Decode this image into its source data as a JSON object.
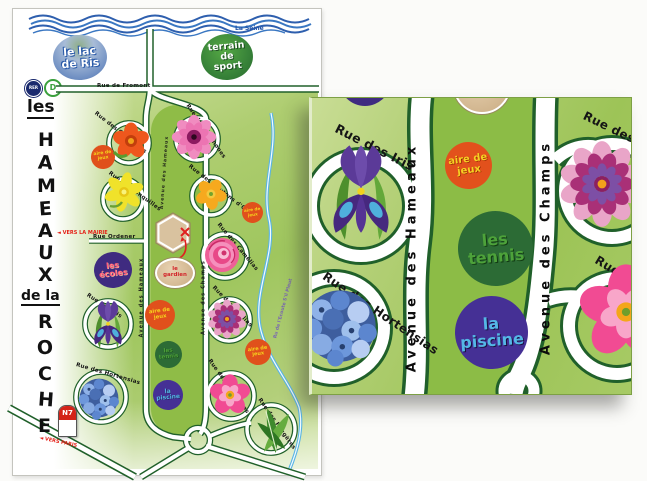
{
  "page": {
    "river_label": "La Seine",
    "lake": {
      "l1": "le lac",
      "l2": "de Ris"
    },
    "sport": {
      "l1": "terrain",
      "l2": "de",
      "l3": "sport"
    },
    "rer": {
      "badge": "RER",
      "line": "D",
      "arrow": "◄"
    },
    "title": {
      "les": "les",
      "hameaux": [
        "H",
        "A",
        "M",
        "E",
        "A",
        "U",
        "X"
      ],
      "dela": "de la",
      "roche": [
        "R",
        "O",
        "C",
        "H",
        "E"
      ]
    },
    "streets": {
      "fromont": "Rue de Fromont",
      "ordener": "Rue Ordener",
      "capucines": "Rue des Capucines",
      "anemones": "Rue des Anémones",
      "jonquilles": "Rue des Jonquilles",
      "boutons_dor": "Rue des Boutons d'Or",
      "camelias": "Rue des Camélias",
      "iris": "Rue des Iris",
      "dahlias": "Rue des Dahlias",
      "hortensias": "Rue des Hortensias",
      "eglantines": "Rue des Églantines",
      "fougeres": "Rue des Fougères",
      "av_hameaux": "Avenue des Hameaux",
      "av_champs": "Avenue des Champs"
    },
    "pois": {
      "aire": {
        "l1": "aire de",
        "l2": "jeux"
      },
      "ecoles": {
        "l1": "les",
        "l2": "écoles"
      },
      "gardien": {
        "l1": "le",
        "l2": "gardien"
      },
      "tennis": {
        "l1": "les",
        "l2": "tennis"
      },
      "piscine": {
        "l1": "la",
        "l2": "piscine"
      }
    },
    "directions": {
      "mairie": "◄ VERS LA MAIRIE",
      "paris": "◄ VERS PARIS"
    },
    "n7": "N7",
    "stream": "Ru de l'Ecoute S'il Pleut",
    "colors": {
      "road_outline": "#20602a",
      "aire_bg": "#e0501c",
      "aire_text": "#f5d21c",
      "ecoles_bg": "#3f2b80",
      "ecoles_text": "#ff5d7a",
      "gardien_bg": "#d9c19e",
      "tennis_bg": "#2c6b35",
      "tennis_text": "#4da23a",
      "piscine_bg": "#453095",
      "piscine_text": "#54b7e6",
      "seine_blue": "#2e5fae",
      "stream_blue": "#5ab4e4",
      "n7_red": "#d42318"
    }
  }
}
